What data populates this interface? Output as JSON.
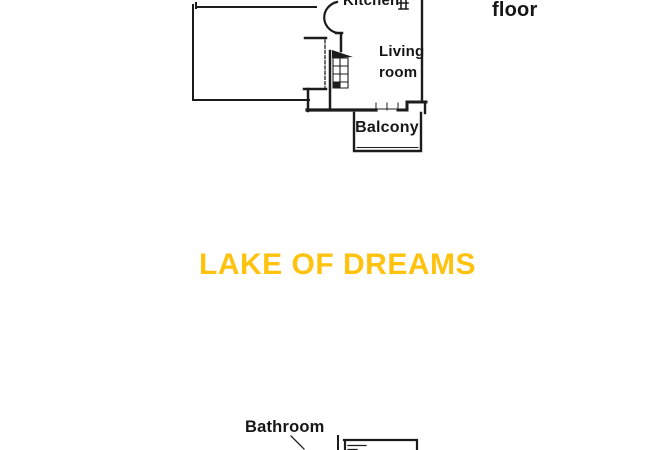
{
  "page": {
    "background_color": "#ffffff",
    "plan_line_color": "#1c1c1c",
    "text_color": "#161616"
  },
  "upper_floor_plan": {
    "floor_label": "floor",
    "kitchen_label": "Kitchen",
    "living_room_label": "Living\nroom",
    "balcony_label": "Balcony",
    "icons": {
      "stairs": "stairs-icon",
      "kitchen_fixture": "kitchen-fixture-icon"
    }
  },
  "banner": {
    "text": "LAKE OF DREAMS",
    "color": "#FFC20E"
  },
  "lower_floor_plan": {
    "bathroom_label": "Bathroom"
  }
}
